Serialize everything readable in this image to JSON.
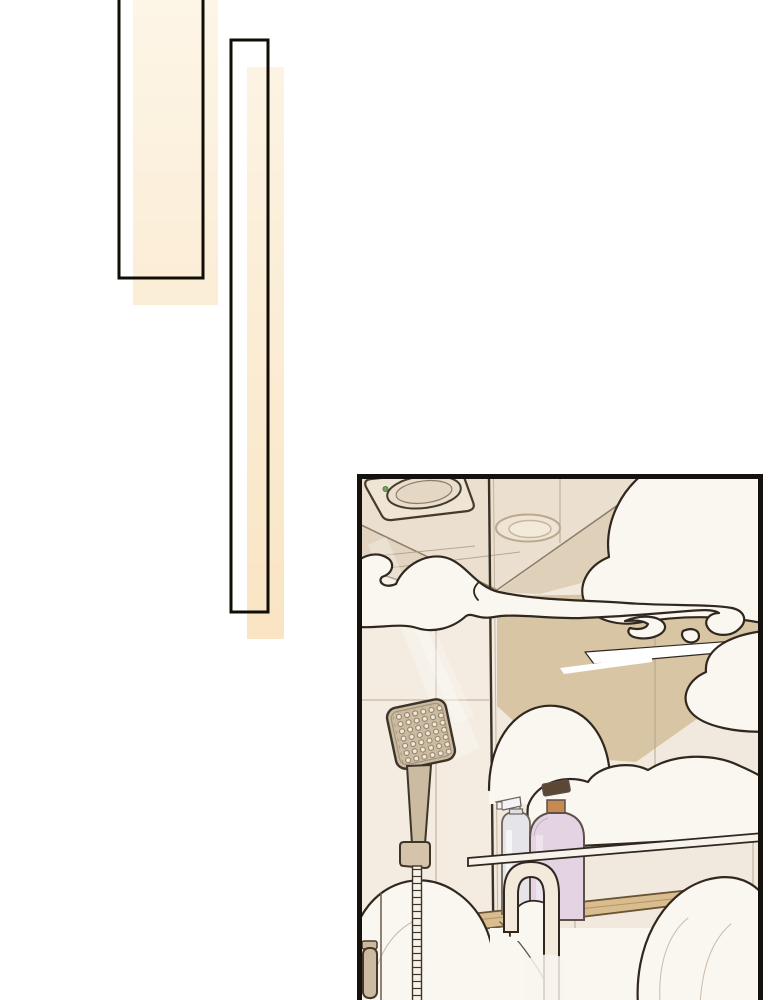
{
  "page": {
    "kind": "comic-episode-page",
    "background": "#ffffff"
  },
  "decor_bars": {
    "outline_color": "#100d07",
    "cream_top": "#fdf5e7",
    "cream_bottom": "#f9e4c2"
  },
  "panel": {
    "border_color": "#15110c",
    "colors": {
      "wall": "#f4ece0",
      "wall_right": "#f1e9dd",
      "ceiling": "#ebe0cf",
      "ceiling_band": "#e2d4c0",
      "ceiling_wedge": "#dfd0ba",
      "wall_tan": "#d8c5a4",
      "tile_line": "#ad9d85",
      "cloud_fill": "#faf6f0",
      "cloud_outline": "#30271f",
      "fixture_tan": "#cbbba1",
      "fixture_outline": "#3e352a",
      "wood_shelf": "#d9bd90",
      "wood_outline": "#6b5434",
      "bottle_white": "#e5e4e8",
      "bottle_white_outline": "#6e655c",
      "bottle_pink": "#e3d3e3",
      "bottle_pink_outline": "#5e4f47",
      "bottle_pump_orange": "#c58a52",
      "bottle_pump_dark": "#5a4734",
      "faucet": "#f3eadc",
      "glass_line": "#393026",
      "glass_highlight": "#c2b097",
      "led_green": "#75a159"
    },
    "objects": [
      "ventilation-fan",
      "ceiling-light",
      "steam-clouds",
      "glass-partition",
      "shower-head",
      "shower-hose",
      "shampoo-bottles",
      "glass-shelf",
      "wood-shelf",
      "faucet",
      "door-handle"
    ]
  }
}
